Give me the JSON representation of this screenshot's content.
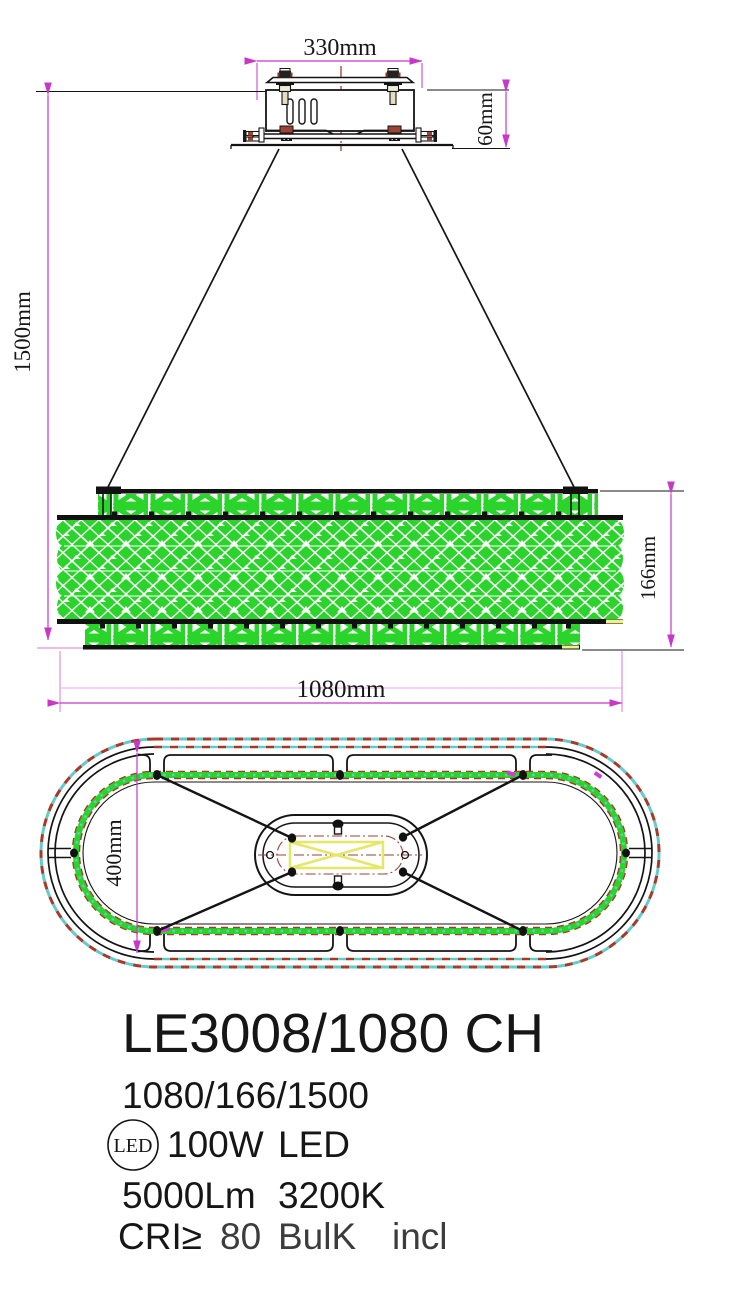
{
  "dims": {
    "d330": "330mm",
    "d60": "60mm",
    "d1500": "1500mm",
    "d166": "166mm",
    "d1080": "1080mm",
    "d400": "400mm"
  },
  "specs": {
    "model": "LE3008/1080 CH",
    "size_code": "1080/166/1500",
    "led_badge": "LED",
    "power": "100W",
    "source": "LED",
    "lumens": "5000Lm",
    "color_temp": "3200K",
    "cri_prefix": "CRI≥",
    "cri_value": "80",
    "bulb_note": "BulK",
    "included_note": "incl"
  },
  "colors": {
    "dimension_magenta": "#c837c8",
    "light_magenta": "#e2a9e2",
    "lattice_green": "#2bd42b",
    "centerline_red": "#9c4038",
    "dash_red": "#a83828",
    "dash_cyan": "#62cccc",
    "accent_yellow": "#efef8e",
    "line_black": "#141414"
  }
}
